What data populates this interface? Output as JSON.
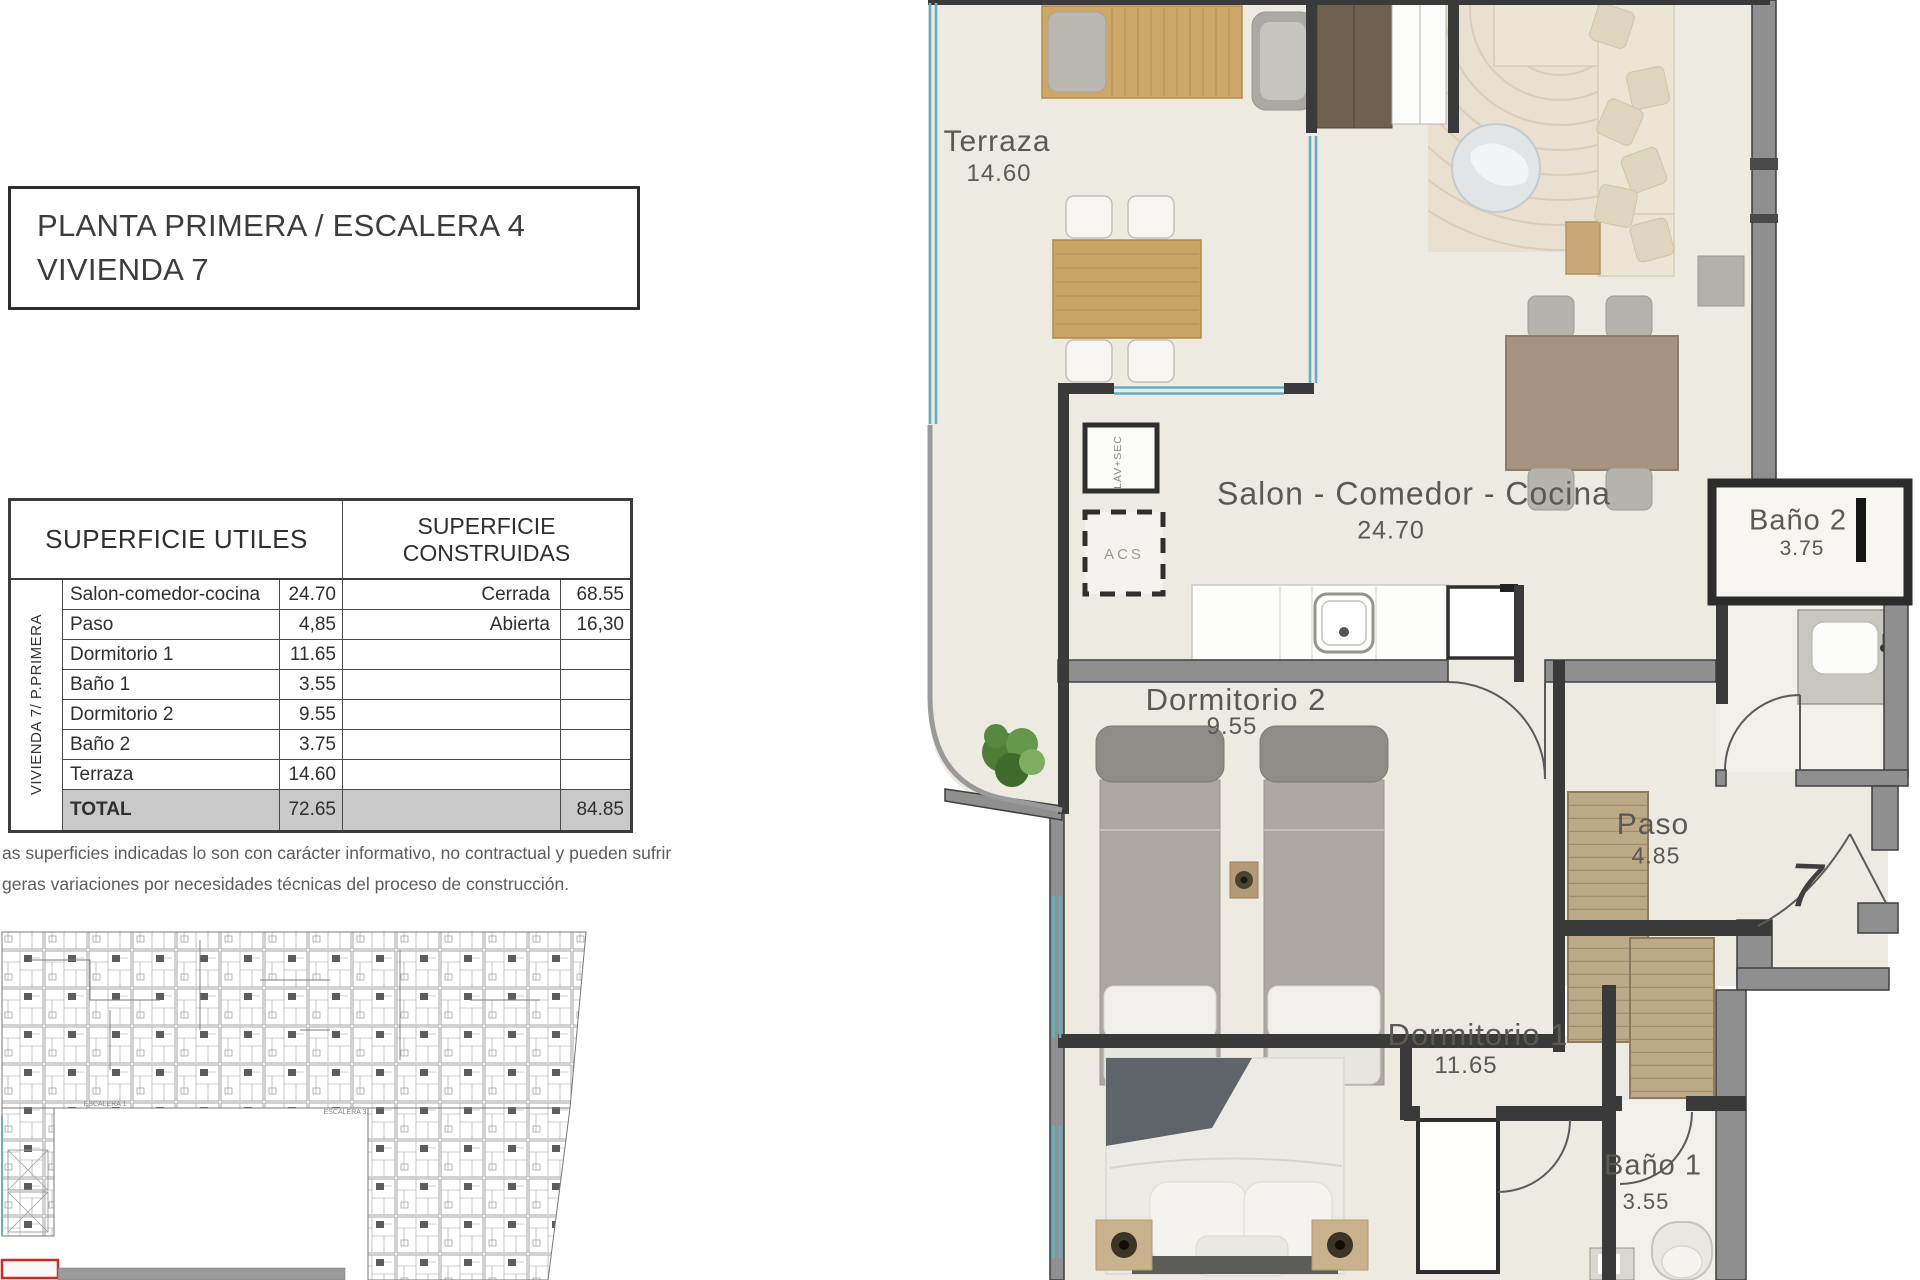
{
  "title_block": {
    "line1": "PLANTA PRIMERA / ESCALERA 4",
    "line2": "VIVIENDA 7"
  },
  "area_table": {
    "header_left": "SUPERFICIE UTILES",
    "header_right_line1": "SUPERFICIE",
    "header_right_line2": "CONSTRUIDAS",
    "vertical_label": "VIVIENDA 7/ P.PRIMERA",
    "rows": [
      {
        "name": "Salon-comedor-cocina",
        "value": "24.70",
        "built_label": "Cerrada",
        "built_value": "68.55"
      },
      {
        "name": "Paso",
        "value": "4,85",
        "built_label": "Abierta",
        "built_value": "16,30"
      },
      {
        "name": "Dormitorio 1",
        "value": "11.65",
        "built_label": "",
        "built_value": ""
      },
      {
        "name": "Baño 1",
        "value": "3.55",
        "built_label": "",
        "built_value": ""
      },
      {
        "name": "Dormitorio 2",
        "value": "9.55",
        "built_label": "",
        "built_value": ""
      },
      {
        "name": "Baño 2",
        "value": "3.75",
        "built_label": "",
        "built_value": ""
      },
      {
        "name": "Terraza",
        "value": "14.60",
        "built_label": "",
        "built_value": ""
      }
    ],
    "total_row": {
      "name": "TOTAL",
      "value": "72.65",
      "built_value": "84.85"
    }
  },
  "disclaimer": {
    "line1": "as superficies indicadas lo son con carácter informativo, no contractual y pueden sufrir",
    "line2": "geras variaciones por necesidades técnicas del proceso de construcción."
  },
  "floor_plan": {
    "rooms": [
      {
        "name": "Terraza",
        "area": "14.60"
      },
      {
        "name": "Salon - Comedor - Cocina",
        "area": "24.70"
      },
      {
        "name": "Baño 2",
        "area": "3.75"
      },
      {
        "name": "Dormitorio 2",
        "area": "9.55"
      },
      {
        "name": "Paso",
        "area": "4.85"
      },
      {
        "name": "Dormitorio 1",
        "area": "11.65"
      },
      {
        "name": "Baño 1",
        "area": "3.55"
      }
    ],
    "unit_number": "7",
    "labels": {
      "lav": "LAV+SEC",
      "acs": "ACS"
    }
  },
  "site_plan": {
    "labels": [
      "ESCALERA 1",
      "ESCALERA 3"
    ]
  },
  "colors": {
    "floor": "#edeae2",
    "bath_floor": "#f1f0eb",
    "wall_gray": "#8f8f8f",
    "wall_dark": "#3a3a3a",
    "glazing_teal": "#63b1be",
    "wood": "#cda767",
    "total_row_bg": "#c9c9c9",
    "highlight_red": "#cc2a2a"
  }
}
